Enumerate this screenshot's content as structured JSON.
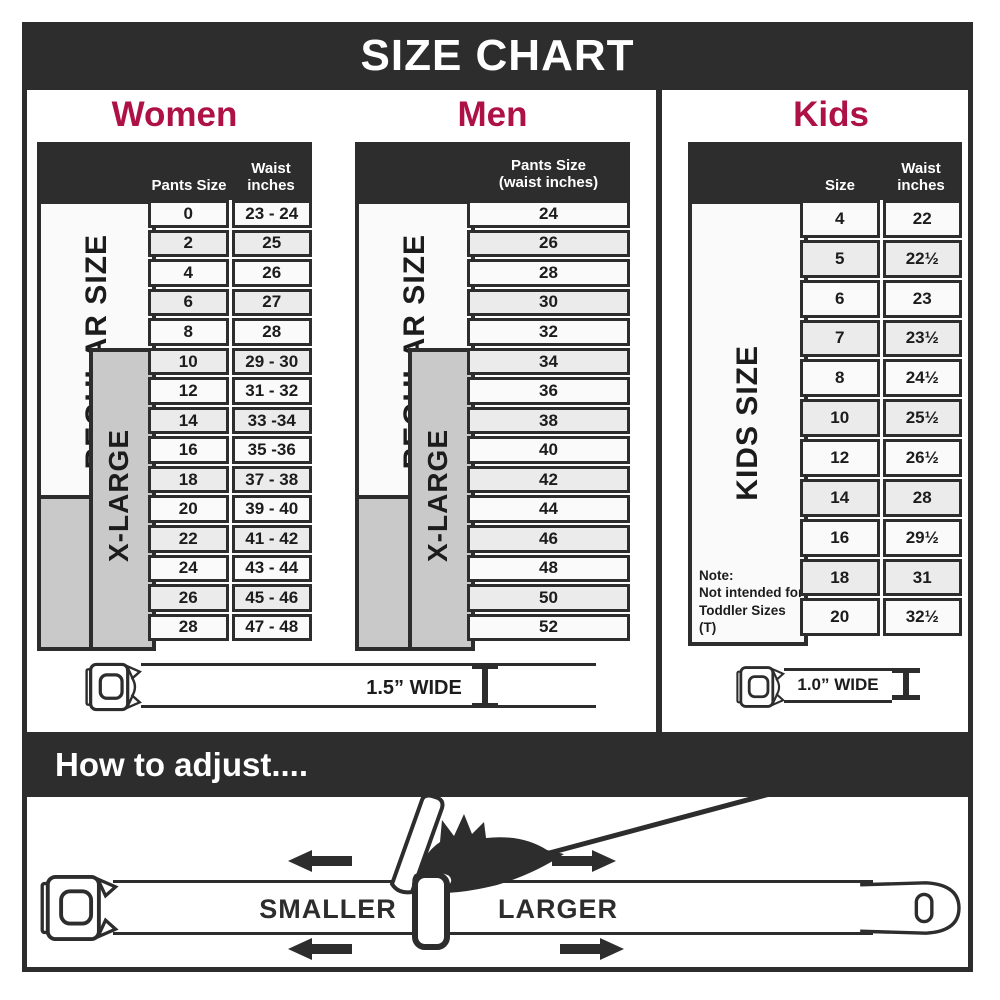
{
  "title": "SIZE CHART",
  "colors": {
    "dark": "#2d2d2d",
    "accent_red": "#ae1145",
    "row_light": "#fafafa",
    "row_alt": "#ebebeb",
    "gray_box": "#c9c9c9"
  },
  "women": {
    "title": "Women",
    "header": {
      "pants": "Pants Size",
      "waist1": "Waist",
      "waist2": "inches"
    },
    "side": {
      "regular": "REGULAR SIZE",
      "xlarge": "X-LARGE"
    },
    "rows": [
      [
        "0",
        "23 - 24"
      ],
      [
        "2",
        "25"
      ],
      [
        "4",
        "26"
      ],
      [
        "6",
        "27"
      ],
      [
        "8",
        "28"
      ],
      [
        "10",
        "29 - 30"
      ],
      [
        "12",
        "31 - 32"
      ],
      [
        "14",
        "33 -34"
      ],
      [
        "16",
        "35 -36"
      ],
      [
        "18",
        "37 - 38"
      ],
      [
        "20",
        "39 - 40"
      ],
      [
        "22",
        "41 - 42"
      ],
      [
        "24",
        "43 - 44"
      ],
      [
        "26",
        "45 - 46"
      ],
      [
        "28",
        "47 - 48"
      ]
    ]
  },
  "men": {
    "title": "Men",
    "header": {
      "line1": "Pants Size",
      "line2": "(waist inches)"
    },
    "side": {
      "regular": "REGULAR SIZE",
      "xlarge": "X-LARGE"
    },
    "rows": [
      "24",
      "26",
      "28",
      "30",
      "32",
      "34",
      "36",
      "38",
      "40",
      "42",
      "44",
      "46",
      "48",
      "50",
      "52"
    ]
  },
  "kids": {
    "title": "Kids",
    "header": {
      "size": "Size",
      "waist1": "Waist",
      "waist2": "inches"
    },
    "side": {
      "label": "KIDS SIZE"
    },
    "note": [
      "Note:",
      "Not intended for",
      "Toddler Sizes (T)"
    ],
    "rows": [
      [
        "4",
        "22"
      ],
      [
        "5",
        "22½"
      ],
      [
        "6",
        "23"
      ],
      [
        "7",
        "23½"
      ],
      [
        "8",
        "24½"
      ],
      [
        "10",
        "25½"
      ],
      [
        "12",
        "26½"
      ],
      [
        "14",
        "28"
      ],
      [
        "16",
        "29½"
      ],
      [
        "18",
        "31"
      ],
      [
        "20",
        "32½"
      ]
    ]
  },
  "belts": {
    "adult_width": "1.5” WIDE",
    "kids_width": "1.0” WIDE"
  },
  "adjust": {
    "header": "How to adjust....",
    "smaller": "SMALLER",
    "larger": "LARGER"
  }
}
